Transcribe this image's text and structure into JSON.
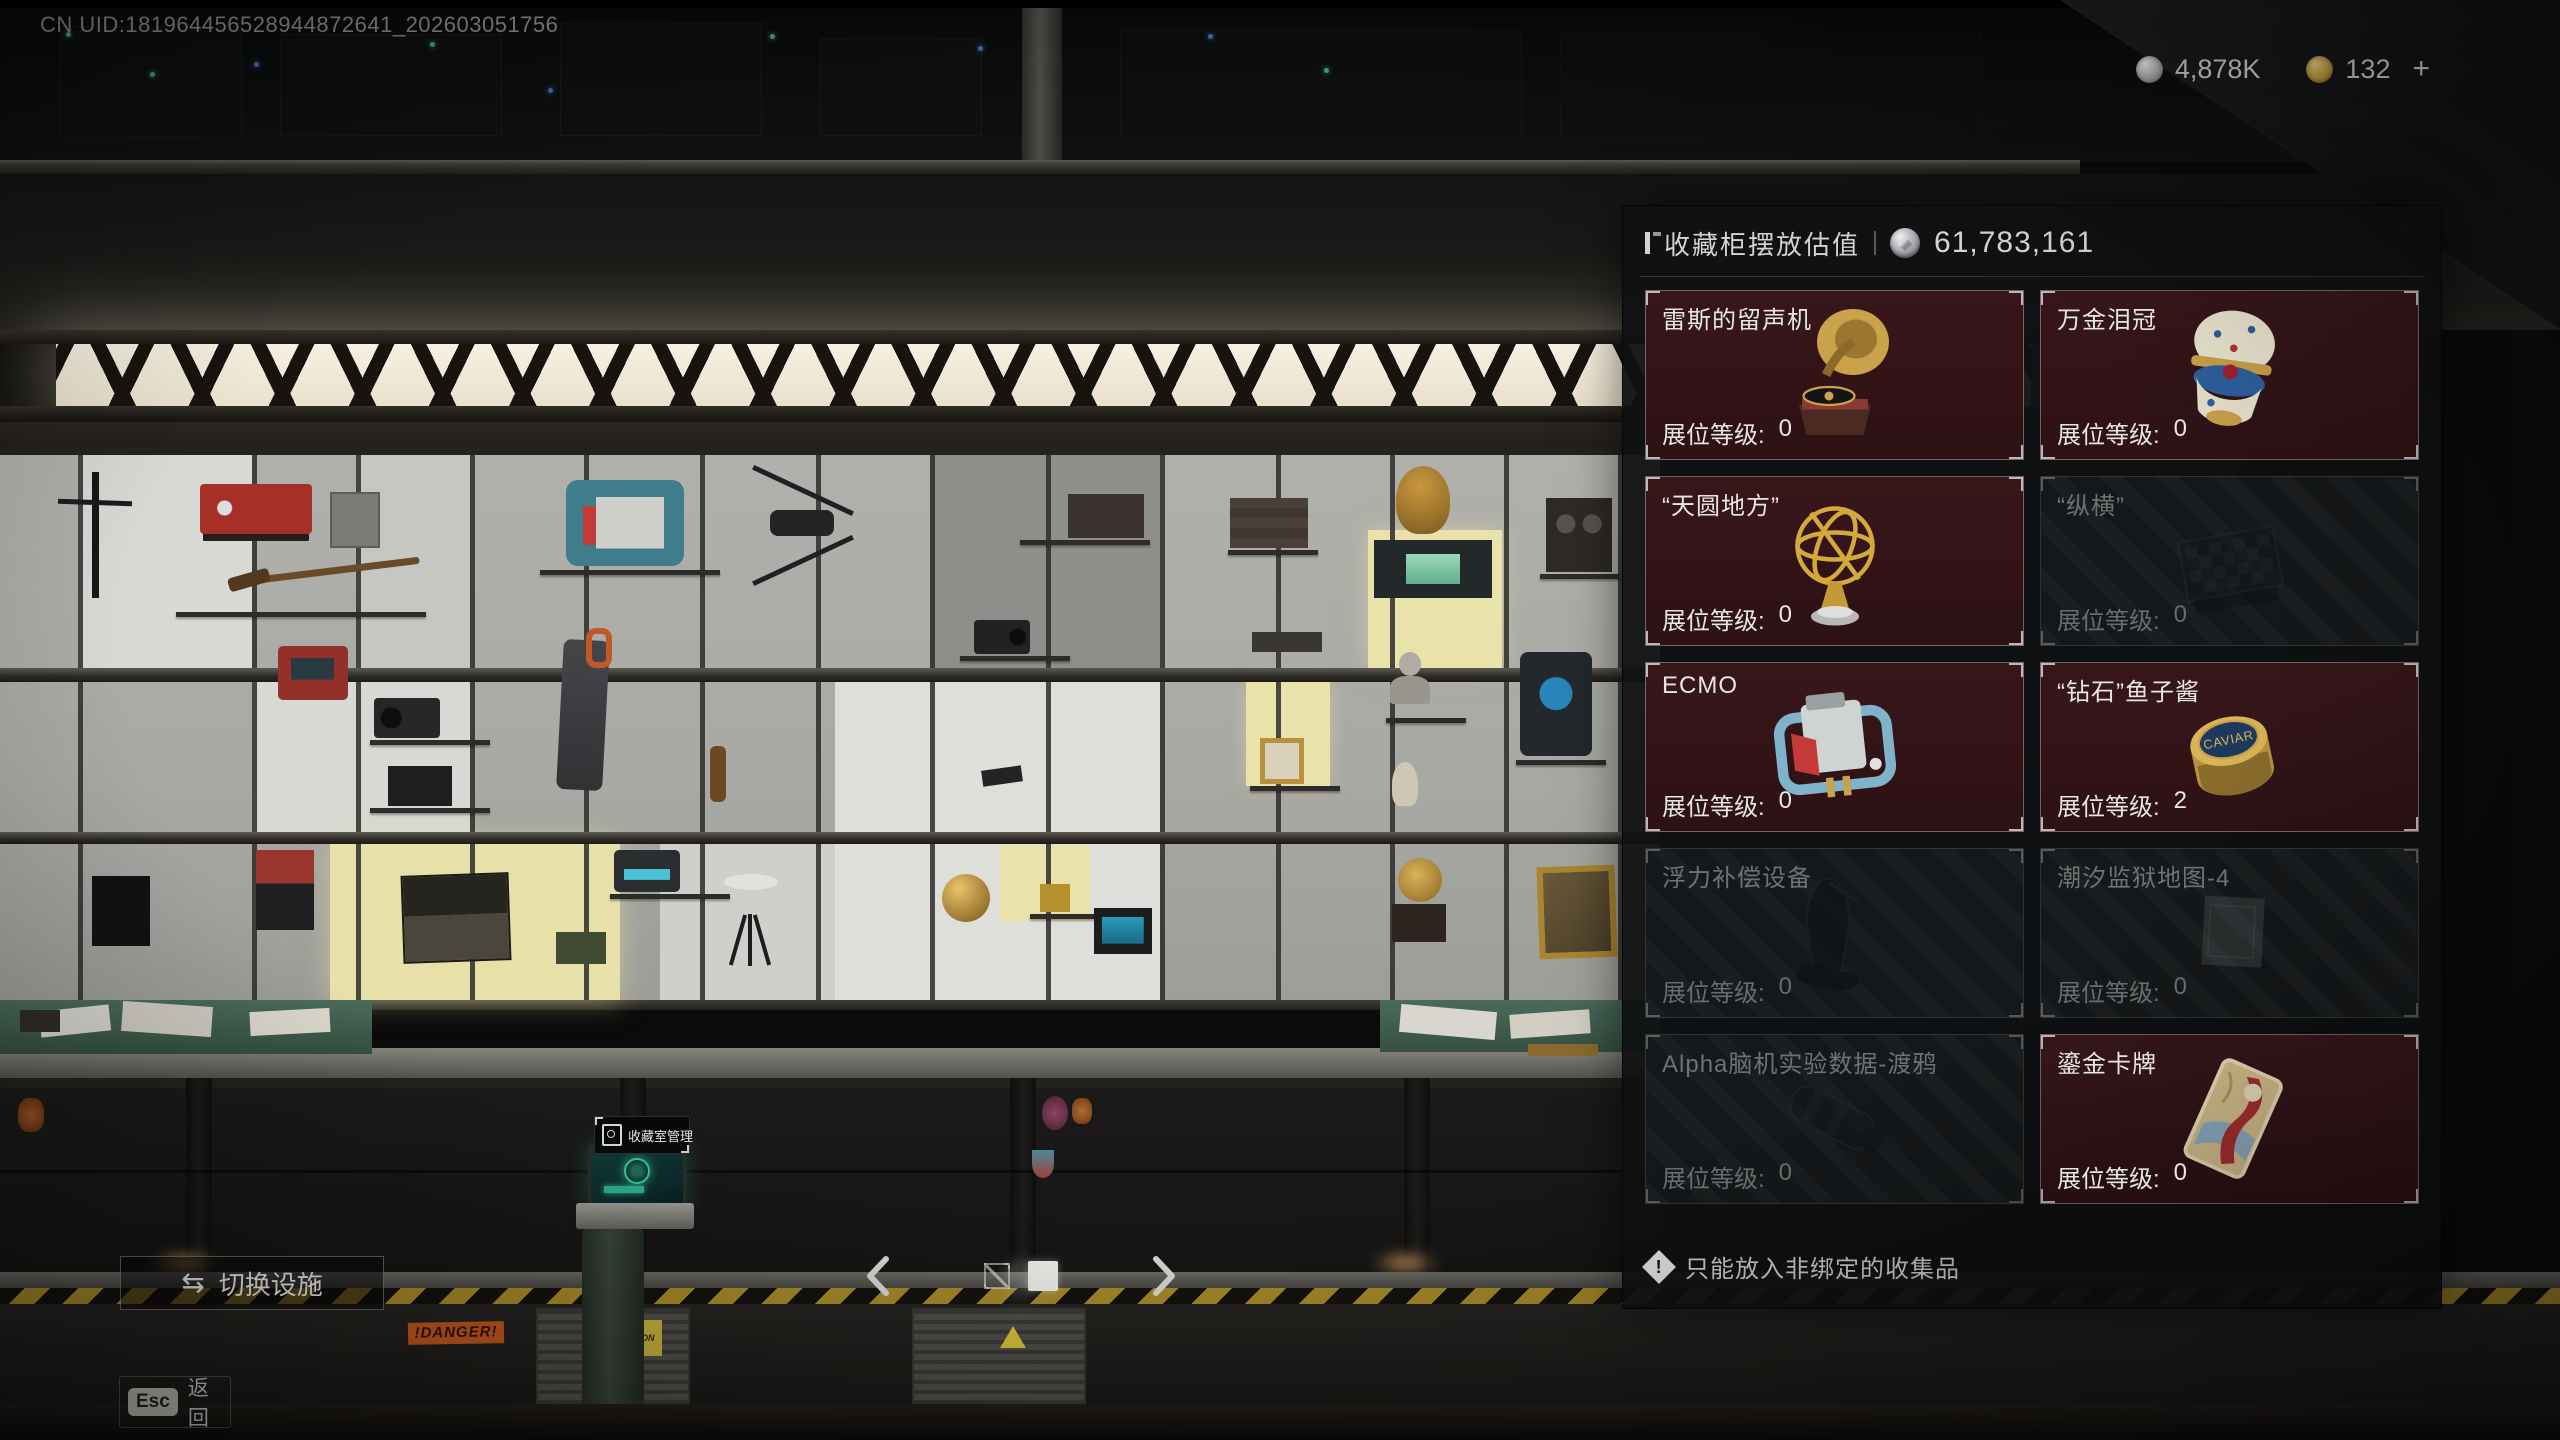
{
  "hud": {
    "uid": "CN UID:181964456528944872641_202603051756",
    "silver_amount": "4,878K",
    "gold_amount": "132",
    "gold_suffix": "+"
  },
  "panel": {
    "title": "收藏柜摆放估值",
    "total_value": "61,783,161",
    "level_label": "展位等级:",
    "footer_note": "只能放入非绑定的收集品",
    "items": [
      {
        "title": "雷斯的留声机",
        "level": "0",
        "state": "active"
      },
      {
        "title": "万金泪冠",
        "level": "0",
        "state": "active"
      },
      {
        "title": "“天圆地方”",
        "level": "0",
        "state": "active"
      },
      {
        "title": "“纵横”",
        "level": "0",
        "state": "disabled"
      },
      {
        "title": "ECMO",
        "level": "0",
        "state": "active"
      },
      {
        "title": "“钻石”鱼子酱",
        "level": "2",
        "state": "active"
      },
      {
        "title": "浮力补偿设备",
        "level": "0",
        "state": "disabled"
      },
      {
        "title": "潮汐监狱地图-4",
        "level": "0",
        "state": "disabled"
      },
      {
        "title": "Alpha脑机实验数据-渡鸦",
        "level": "0",
        "state": "disabled"
      },
      {
        "title": "鎏金卡牌",
        "level": "0",
        "state": "active"
      }
    ]
  },
  "scene": {
    "terminal_tooltip": "收藏室管理",
    "caviar_label": "CAVIAR",
    "danger_sign": "!DANGER!",
    "caution_sign": "CAUTION"
  },
  "controls": {
    "switch_facility": "切换设施",
    "switch_icon": "⇆",
    "esc_key": "Esc",
    "back_label": "返回"
  },
  "pager": {
    "pages": 3,
    "active_index": 1
  },
  "colors": {
    "card_active_bg": "#331518",
    "panel_bg": "#101213",
    "accent_gold": "#d9b457",
    "accent_silver": "#c9cbcd"
  }
}
